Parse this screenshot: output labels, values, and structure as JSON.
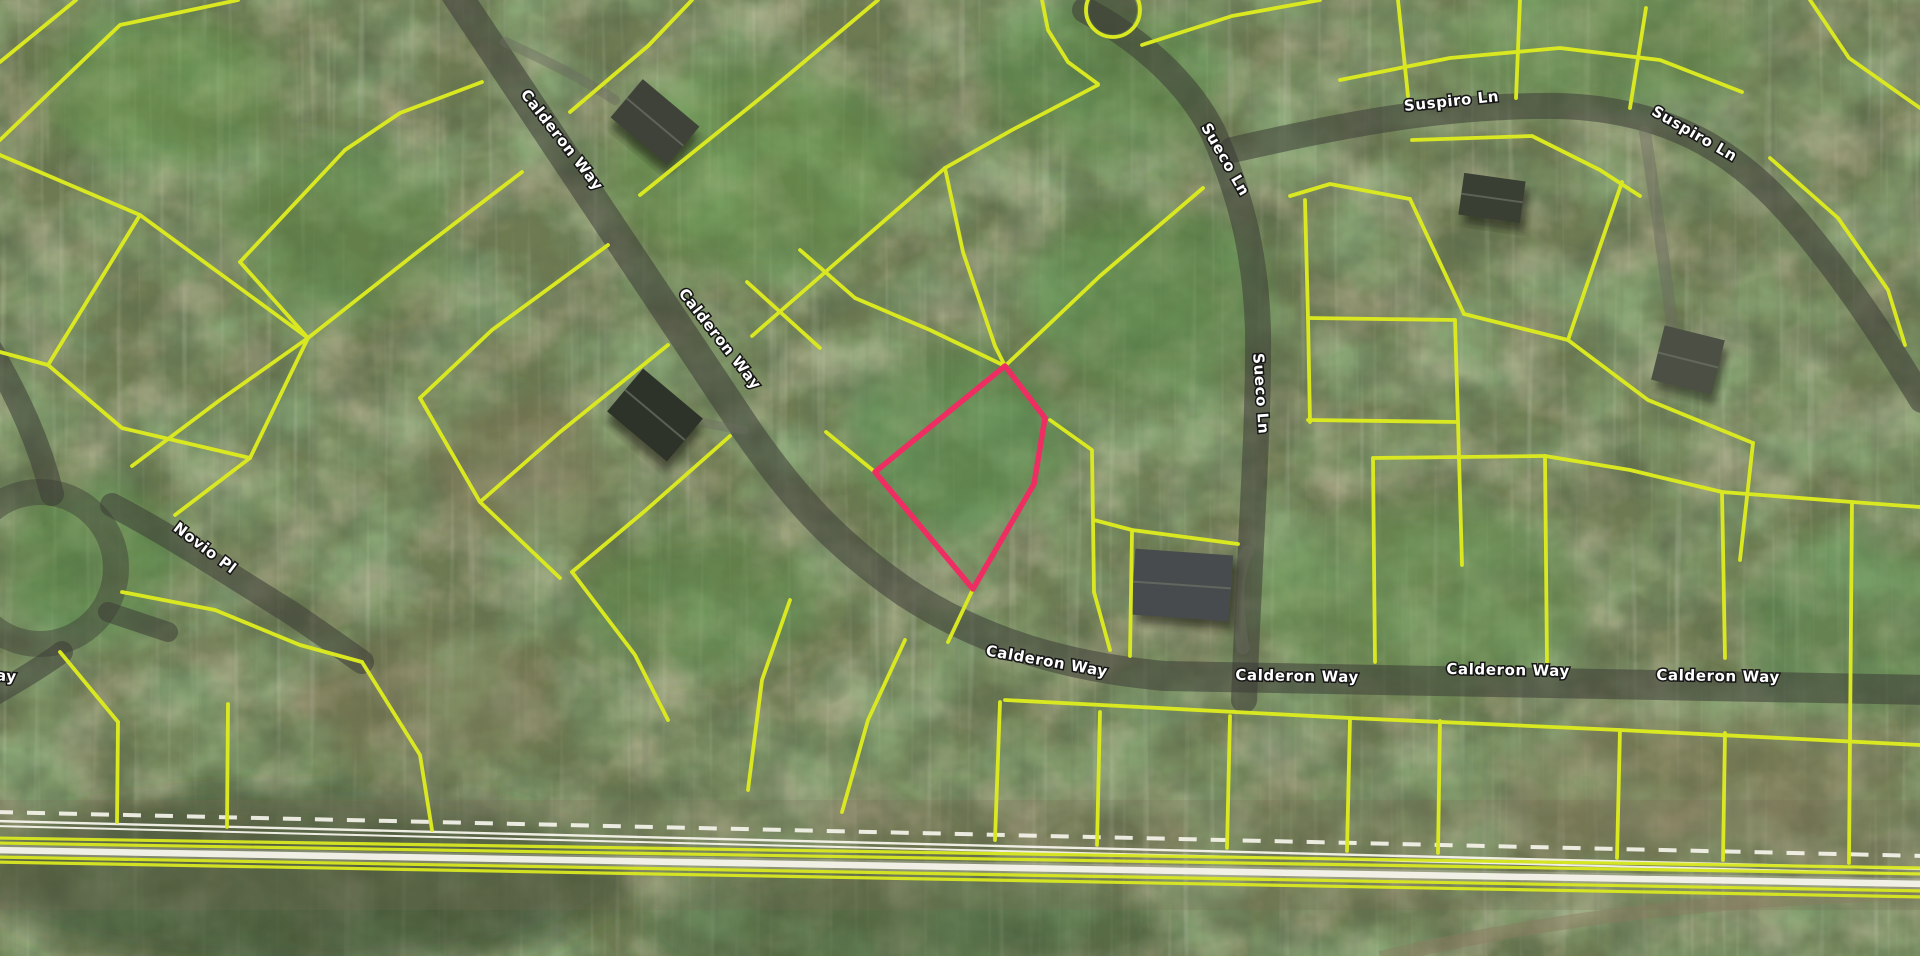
{
  "map": {
    "type": "aerial-parcel-map",
    "streets": [
      "Calderon Way",
      "Sueco Ln",
      "Suspiro Ln",
      "Novio Pl"
    ],
    "colors": {
      "parcel_line": "#d9e821",
      "subject_parcel": "#ee2e63",
      "road_fill": "#3c3c36",
      "label_text": "#ffffff",
      "label_halo": "#161616",
      "rail_white": "#f7f5ec",
      "terrain_base": "#6e7b52"
    },
    "labels": [
      {
        "text": "Calderon Way",
        "x": 558,
        "y": 143,
        "rot": 52,
        "size": 15
      },
      {
        "text": "Calderon Way",
        "x": 716,
        "y": 342,
        "rot": 52,
        "size": 15
      },
      {
        "text": "Calderon Way",
        "x": 1046,
        "y": 666,
        "rot": 10,
        "size": 15
      },
      {
        "text": "Calderon Way",
        "x": 1297,
        "y": 681,
        "rot": 1,
        "size": 15
      },
      {
        "text": "Calderon Way",
        "x": 1508,
        "y": 675,
        "rot": 1,
        "size": 15
      },
      {
        "text": "Calderon Way",
        "x": 1718,
        "y": 681,
        "rot": 1,
        "size": 15
      },
      {
        "text": "Sueco Ln",
        "x": 1221,
        "y": 162,
        "rot": 60,
        "size": 15
      },
      {
        "text": "Sueco Ln",
        "x": 1256,
        "y": 394,
        "rot": 86,
        "size": 15
      },
      {
        "text": "Suspiro Ln",
        "x": 1452,
        "y": 106,
        "rot": -6,
        "size": 15
      },
      {
        "text": "Suspiro Ln",
        "x": 1692,
        "y": 138,
        "rot": 30,
        "size": 15
      },
      {
        "text": "Novio Pl",
        "x": 202,
        "y": 552,
        "rot": 37,
        "size": 15
      },
      {
        "text": "ay",
        "x": 6,
        "y": 681,
        "rot": 4,
        "size": 15
      }
    ],
    "roads": [
      {
        "name": "calderon-way",
        "width": 30,
        "path": "M 452,-12 L 748,432 C 790,492 830,540 905,592 C 985,645 1075,668 1165,676 L 1930,690"
      },
      {
        "name": "sueco-ln",
        "width": 26,
        "path": "M 1085,10 C 1150,45 1192,90 1213,132 C 1243,200 1256,260 1258,330 C 1259,430 1250,540 1244,700"
      },
      {
        "name": "suspiro-ln",
        "width": 26,
        "path": "M 1232,150 C 1330,128 1440,104 1560,106 C 1680,110 1745,160 1800,225 C 1850,285 1885,340 1922,400"
      },
      {
        "name": "novio-pl",
        "width": 24,
        "path": "M 112,505 C 170,535 230,575 290,612 C 320,632 345,650 362,662"
      },
      {
        "name": "novio-approach",
        "width": 24,
        "path": "M -12,345 C 20,400 40,445 52,494"
      },
      {
        "name": "loop-stub",
        "width": 20,
        "path": "M 108,612 L 168,632"
      },
      {
        "name": "left-edge-stub",
        "width": 22,
        "path": "M -15,700 C 20,680 45,665 62,652"
      }
    ],
    "loop_road": {
      "cx": 40,
      "cy": 568,
      "r": 76,
      "width": 26
    },
    "culdesac_bulb": {
      "cx": 1113,
      "cy": 10,
      "r": 24
    },
    "driveways": [
      {
        "path": "M 505,42 C 550,62 585,80 615,100",
        "width": 10
      },
      {
        "path": "M 1247,552 C 1234,578 1237,612 1243,648",
        "width": 13
      },
      {
        "path": "M 1645,132 C 1655,200 1665,265 1672,325",
        "width": 12
      },
      {
        "path": "M 744,430 C 716,426 694,421 676,417",
        "width": 9
      }
    ],
    "culdesac_circle_line": {
      "cx": 1113,
      "cy": 10,
      "r": 27
    },
    "parcel_arcs": [
      [
        [
          1040,
          -10
        ],
        [
          1048,
          30
        ],
        [
          1068,
          62
        ],
        [
          1098,
          84
        ]
      ]
    ],
    "parcel_lines": [
      [
        [
          0,
          62
        ],
        [
          76,
          0
        ]
      ],
      [
        [
          0,
          140
        ],
        [
          120,
          25
        ],
        [
          238,
          0
        ]
      ],
      [
        [
          0,
          155
        ],
        [
          140,
          215
        ],
        [
          308,
          338
        ]
      ],
      [
        [
          140,
          215
        ],
        [
          48,
          365
        ]
      ],
      [
        [
          48,
          365
        ],
        [
          0,
          352
        ]
      ],
      [
        [
          48,
          365
        ],
        [
          122,
          428
        ],
        [
          250,
          458
        ]
      ],
      [
        [
          308,
          338
        ],
        [
          250,
          458
        ]
      ],
      [
        [
          308,
          338
        ],
        [
          420,
          250
        ],
        [
          522,
          172
        ]
      ],
      [
        [
          482,
          82
        ],
        [
          400,
          113
        ],
        [
          345,
          150
        ]
      ],
      [
        [
          345,
          150
        ],
        [
          240,
          262
        ]
      ],
      [
        [
          240,
          262
        ],
        [
          308,
          338
        ]
      ],
      [
        [
          608,
          245
        ],
        [
          492,
          330
        ],
        [
          420,
          398
        ]
      ],
      [
        [
          668,
          345
        ],
        [
          560,
          432
        ],
        [
          480,
          502
        ]
      ],
      [
        [
          420,
          398
        ],
        [
          480,
          502
        ],
        [
          560,
          578
        ]
      ],
      [
        [
          730,
          436
        ],
        [
          646,
          510
        ],
        [
          572,
          572
        ]
      ],
      [
        [
          250,
          458
        ],
        [
          175,
          515
        ]
      ],
      [
        [
          572,
          572
        ],
        [
          635,
          655
        ],
        [
          668,
          720
        ]
      ],
      [
        [
          362,
          662
        ],
        [
          420,
          755
        ],
        [
          432,
          830
        ]
      ],
      [
        [
          118,
          722
        ],
        [
          117,
          822
        ]
      ],
      [
        [
          228,
          704
        ],
        [
          227,
          827
        ]
      ],
      [
        [
          60,
          652
        ],
        [
          118,
          722
        ]
      ],
      [
        [
          132,
          466
        ],
        [
          220,
          400
        ],
        [
          308,
          338
        ]
      ],
      [
        [
          122,
          592
        ],
        [
          215,
          610
        ],
        [
          300,
          645
        ],
        [
          362,
          662
        ]
      ],
      [
        [
          878,
          0
        ],
        [
          768,
          92
        ],
        [
          640,
          195
        ]
      ],
      [
        [
          570,
          112
        ],
        [
          648,
          46
        ],
        [
          692,
          0
        ]
      ],
      [
        [
          1098,
          85
        ],
        [
          1012,
          130
        ],
        [
          945,
          168
        ]
      ],
      [
        [
          945,
          168
        ],
        [
          830,
          268
        ],
        [
          752,
          336
        ]
      ],
      [
        [
          945,
          168
        ],
        [
          963,
          252
        ],
        [
          995,
          346
        ],
        [
          1005,
          366
        ]
      ],
      [
        [
          1005,
          366
        ],
        [
          1100,
          276
        ],
        [
          1203,
          188
        ]
      ],
      [
        [
          855,
          298
        ],
        [
          930,
          330
        ],
        [
          1005,
          366
        ]
      ],
      [
        [
          800,
          250
        ],
        [
          855,
          298
        ]
      ],
      [
        [
          747,
          282
        ],
        [
          820,
          348
        ]
      ],
      [
        [
          826,
          432
        ],
        [
          875,
          472
        ]
      ],
      [
        [
          1050,
          420
        ],
        [
          1092,
          450
        ],
        [
          1094,
          592
        ]
      ],
      [
        [
          1094,
          520
        ],
        [
          1132,
          530
        ],
        [
          1238,
          544
        ]
      ],
      [
        [
          1132,
          532
        ],
        [
          1130,
          656
        ]
      ],
      [
        [
          973,
          589
        ],
        [
          948,
          642
        ]
      ],
      [
        [
          1094,
          592
        ],
        [
          1110,
          650
        ]
      ],
      [
        [
          1142,
          45
        ],
        [
          1232,
          16
        ],
        [
          1320,
          0
        ]
      ],
      [
        [
          1340,
          80
        ],
        [
          1450,
          58
        ],
        [
          1560,
          48
        ],
        [
          1660,
          60
        ],
        [
          1742,
          92
        ]
      ],
      [
        [
          1398,
          0
        ],
        [
          1408,
          96
        ]
      ],
      [
        [
          1520,
          0
        ],
        [
          1516,
          98
        ]
      ],
      [
        [
          1646,
          8
        ],
        [
          1630,
          108
        ]
      ],
      [
        [
          1810,
          0
        ],
        [
          1849,
          58
        ],
        [
          1920,
          108
        ]
      ],
      [
        [
          1412,
          140
        ],
        [
          1532,
          136
        ],
        [
          1600,
          170
        ],
        [
          1640,
          196
        ]
      ],
      [
        [
          1770,
          158
        ],
        [
          1838,
          218
        ],
        [
          1888,
          290
        ],
        [
          1905,
          345
        ]
      ],
      [
        [
          1290,
          196
        ],
        [
          1330,
          184
        ],
        [
          1410,
          199
        ]
      ],
      [
        [
          1410,
          199
        ],
        [
          1464,
          314
        ]
      ],
      [
        [
          1464,
          314
        ],
        [
          1568,
          340
        ]
      ],
      [
        [
          1568,
          340
        ],
        [
          1622,
          182
        ]
      ],
      [
        [
          1568,
          340
        ],
        [
          1648,
          400
        ],
        [
          1753,
          443
        ]
      ],
      [
        [
          1753,
          443
        ],
        [
          1740,
          560
        ]
      ],
      [
        [
          1305,
          200
        ],
        [
          1308,
          318
        ]
      ],
      [
        [
          1308,
          318
        ],
        [
          1455,
          320
        ]
      ],
      [
        [
          1455,
          320
        ],
        [
          1458,
          422
        ]
      ],
      [
        [
          1308,
          318
        ],
        [
          1310,
          422
        ]
      ],
      [
        [
          1308,
          420
        ],
        [
          1458,
          422
        ]
      ],
      [
        [
          1458,
          422
        ],
        [
          1462,
          565
        ]
      ],
      [
        [
          1373,
          458
        ],
        [
          1545,
          456
        ]
      ],
      [
        [
          1373,
          458
        ],
        [
          1375,
          662
        ]
      ],
      [
        [
          1545,
          456
        ],
        [
          1547,
          662
        ]
      ],
      [
        [
          1545,
          456
        ],
        [
          1630,
          470
        ],
        [
          1722,
          492
        ]
      ],
      [
        [
          1722,
          492
        ],
        [
          1725,
          658
        ]
      ],
      [
        [
          1722,
          492
        ],
        [
          1852,
          502
        ],
        [
          1920,
          507
        ]
      ],
      [
        [
          1852,
          502
        ],
        [
          1850,
          738
        ]
      ],
      [
        [
          1005,
          700
        ],
        [
          1350,
          718
        ],
        [
          1620,
          730
        ],
        [
          1920,
          745
        ]
      ],
      [
        [
          1000,
          702
        ],
        [
          995,
          840
        ]
      ],
      [
        [
          1100,
          712
        ],
        [
          1097,
          845
        ]
      ],
      [
        [
          1230,
          716
        ],
        [
          1227,
          848
        ]
      ],
      [
        [
          1350,
          718
        ],
        [
          1347,
          851
        ]
      ],
      [
        [
          1440,
          721
        ],
        [
          1438,
          853
        ]
      ],
      [
        [
          1620,
          730
        ],
        [
          1617,
          858
        ]
      ],
      [
        [
          1725,
          733
        ],
        [
          1723,
          860
        ]
      ],
      [
        [
          1850,
          738
        ],
        [
          1849,
          863
        ]
      ],
      [
        [
          905,
          640
        ],
        [
          868,
          720
        ],
        [
          842,
          812
        ]
      ],
      [
        [
          790,
          600
        ],
        [
          762,
          680
        ],
        [
          748,
          790
        ]
      ]
    ],
    "subject_parcel": {
      "points": [
        [
          1005,
          366
        ],
        [
          1045,
          418
        ],
        [
          1034,
          484
        ],
        [
          973,
          589
        ],
        [
          875,
          472
        ]
      ],
      "stroke_width": 5.5
    },
    "railroad": {
      "dashed_line": {
        "x1": -5,
        "y1": 812,
        "x2": 1925,
        "y2": 856
      },
      "lines": [
        {
          "x1": -5,
          "y1": 821,
          "x2": 1925,
          "y2": 869,
          "w": 2.4,
          "kind": "white-thin"
        },
        {
          "x1": -5,
          "y1": 826,
          "x2": 1925,
          "y2": 874,
          "w": 2.0,
          "kind": "white-thin"
        },
        {
          "x1": -5,
          "y1": 838,
          "x2": 1925,
          "y2": 868,
          "w": 3.2,
          "kind": "yellow"
        },
        {
          "x1": -5,
          "y1": 843,
          "x2": 1925,
          "y2": 874,
          "w": 3.2,
          "kind": "yellow"
        },
        {
          "x1": -5,
          "y1": 850,
          "x2": 1925,
          "y2": 884,
          "w": 11,
          "kind": "white-glow"
        },
        {
          "x1": -5,
          "y1": 850,
          "x2": 1925,
          "y2": 884,
          "w": 6.5,
          "kind": "white-thick"
        },
        {
          "x1": -5,
          "y1": 857,
          "x2": 1925,
          "y2": 891,
          "w": 3.2,
          "kind": "yellow"
        },
        {
          "x1": -5,
          "y1": 862,
          "x2": 1925,
          "y2": 897,
          "w": 3.2,
          "kind": "yellow"
        }
      ],
      "dirt_path": "M 1380,958 C 1560,915 1740,898 1925,893"
    },
    "houses": [
      {
        "name": "house-nw",
        "cx": 655,
        "cy": 122,
        "w": 74,
        "h": 50,
        "rot": 40,
        "color": "#3f4238"
      },
      {
        "name": "house-center-west",
        "cx": 655,
        "cy": 415,
        "w": 78,
        "h": 56,
        "rot": 40,
        "color": "#2e3329"
      },
      {
        "name": "house-by-subject",
        "cx": 1182,
        "cy": 585,
        "w": 98,
        "h": 66,
        "rot": 4,
        "color": "#474b4d"
      },
      {
        "name": "house-ne",
        "cx": 1492,
        "cy": 198,
        "w": 62,
        "h": 42,
        "rot": 8,
        "color": "#3a3f33"
      },
      {
        "name": "house-east",
        "cx": 1688,
        "cy": 360,
        "w": 62,
        "h": 56,
        "rot": 14,
        "color": "#4c5044"
      }
    ],
    "canopy_patches": [
      {
        "cx": 160,
        "cy": 90,
        "rx": 120,
        "ry": 80,
        "c": "#5f9448",
        "o": 0.45
      },
      {
        "cx": 340,
        "cy": 230,
        "rx": 110,
        "ry": 90,
        "c": "#54883f",
        "o": 0.4
      },
      {
        "cx": 760,
        "cy": 170,
        "rx": 150,
        "ry": 110,
        "c": "#5f9448",
        "o": 0.45
      },
      {
        "cx": 960,
        "cy": 440,
        "rx": 110,
        "ry": 90,
        "c": "#56904a",
        "o": 0.5
      },
      {
        "cx": 1150,
        "cy": 300,
        "rx": 120,
        "ry": 100,
        "c": "#4f8a40",
        "o": 0.45
      },
      {
        "cx": 1420,
        "cy": 600,
        "rx": 160,
        "ry": 100,
        "c": "#5f9448",
        "o": 0.4
      },
      {
        "cx": 700,
        "cy": 600,
        "rx": 120,
        "ry": 70,
        "c": "#54883f",
        "o": 0.4
      },
      {
        "cx": 1600,
        "cy": 40,
        "rx": 150,
        "ry": 70,
        "c": "#5f9448",
        "o": 0.4
      },
      {
        "cx": 1850,
        "cy": 620,
        "rx": 110,
        "ry": 90,
        "c": "#56904a",
        "o": 0.35
      },
      {
        "cx": 90,
        "cy": 560,
        "rx": 90,
        "ry": 80,
        "c": "#4f8a40",
        "o": 0.45
      },
      {
        "cx": 300,
        "cy": 880,
        "rx": 320,
        "ry": 90,
        "c": "#2e4426",
        "o": 0.55
      },
      {
        "cx": 900,
        "cy": 930,
        "rx": 260,
        "ry": 70,
        "c": "#3a5230",
        "o": 0.4
      },
      {
        "cx": 520,
        "cy": 470,
        "rx": 90,
        "ry": 70,
        "c": "#7d6e50",
        "o": 0.35
      },
      {
        "cx": 1700,
        "cy": 780,
        "rx": 200,
        "ry": 70,
        "c": "#8a7a5c",
        "o": 0.3
      },
      {
        "cx": 1100,
        "cy": 80,
        "rx": 120,
        "ry": 80,
        "c": "#4f8a40",
        "o": 0.4
      },
      {
        "cx": 430,
        "cy": 700,
        "rx": 130,
        "ry": 70,
        "c": "#7d6e50",
        "o": 0.3
      }
    ]
  }
}
